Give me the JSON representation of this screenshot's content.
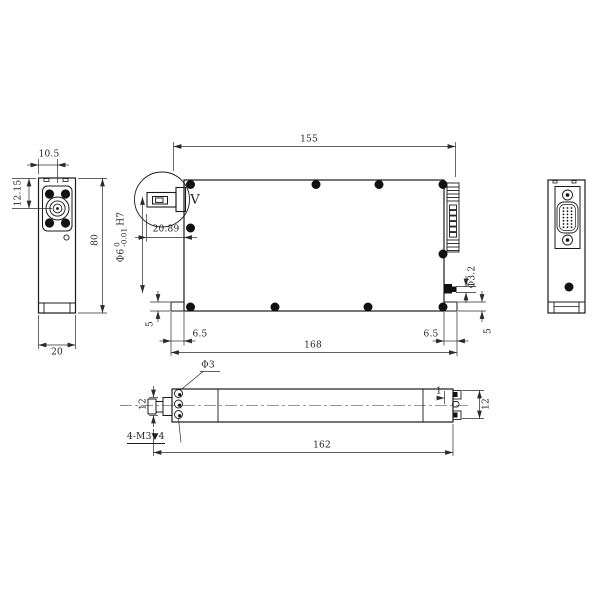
{
  "drawing": {
    "background": "#ffffff",
    "outline_color": "#1a1a1a",
    "dimension_color": "#2b2b2b"
  },
  "labels": {
    "left_top_width": "10.5",
    "left_port_offset": "12.15",
    "left_depth": "20",
    "body_height": "80",
    "top_width": "155",
    "aperture_offset": "20.89",
    "aperture_prefix": "Φ6",
    "aperture_tol_upper": "0",
    "aperture_tol_lower": "-0.01",
    "aperture_fit": "H7",
    "detail_label": "V",
    "stud_dia": "Φ3.2",
    "foot_height_left": "5",
    "foot_height_right": "5",
    "flange_offset_left": "6.5",
    "flange_offset_right": "6.5",
    "flange_width": "168",
    "hole_dia": "Φ3",
    "thread_note": "4-M3▼4",
    "bottom_length": "162",
    "nozzle_height": "12",
    "right_slot_height": "12",
    "bump_offset": "1"
  }
}
